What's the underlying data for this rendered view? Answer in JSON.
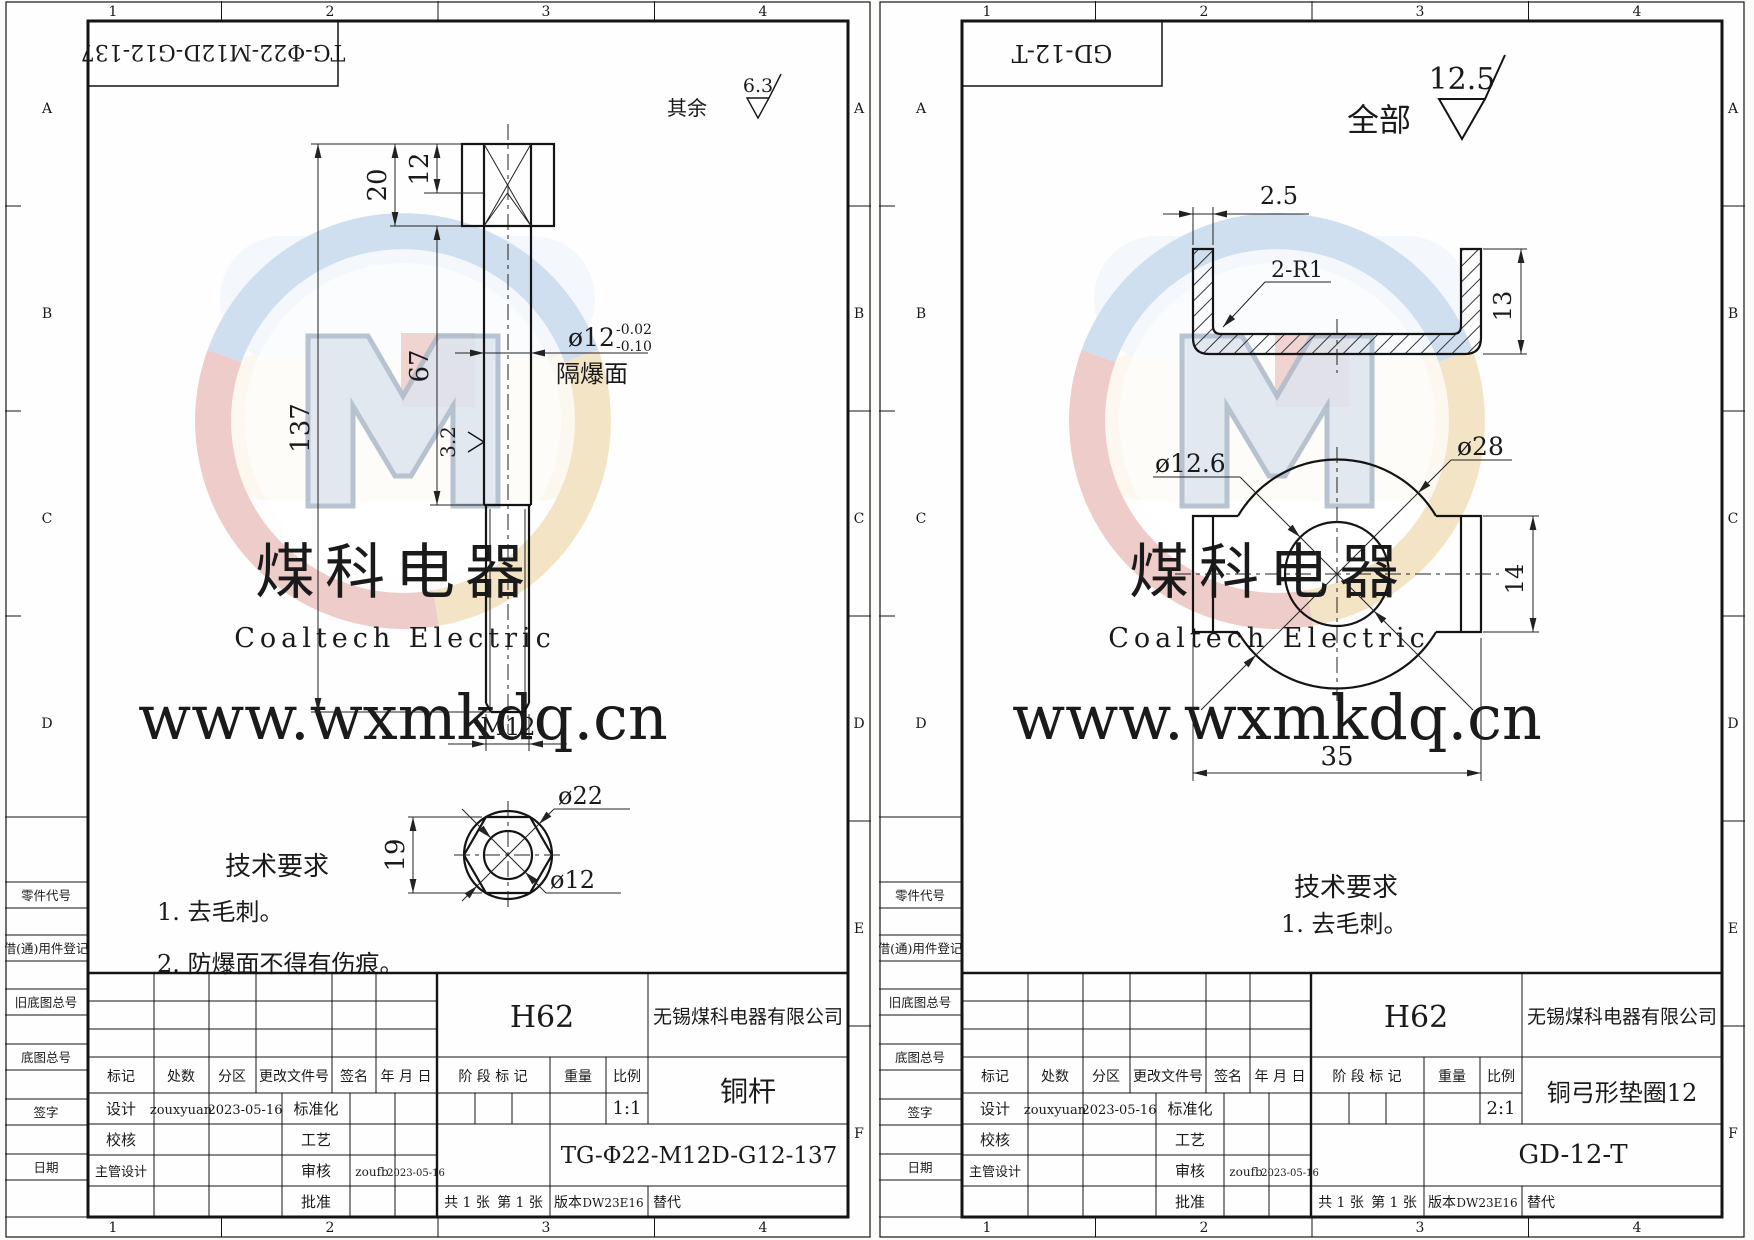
{
  "watermark": {
    "url": "www.wxmkdq.cn",
    "brand_cn": "煤科电器",
    "brand_en": "Coaltech Electric"
  },
  "zones": {
    "cols": [
      "1",
      "2",
      "3",
      "4"
    ],
    "rows": [
      "A",
      "B",
      "C",
      "D",
      "E",
      "F"
    ]
  },
  "margin_labels": [
    "零件代号",
    "借(通)用件登记",
    "旧底图总号",
    "底图总号",
    "签字",
    "日期"
  ],
  "tb_labels": {
    "mark": "标记",
    "count": "处数",
    "zone": "分区",
    "change_doc": "更改文件号",
    "sign": "签名",
    "date": "年 月 日",
    "design": "设计",
    "standard": "标准化",
    "check": "校核",
    "process": "工艺",
    "chief_design": "主管设计",
    "audit": "审核",
    "approve": "批准",
    "stage": "阶 段 标 记",
    "weight": "重量",
    "scale": "比例",
    "sheets": "共 1 张",
    "sheet_no": "第 1 张",
    "version": "版本",
    "replace": "替代"
  },
  "sheet1": {
    "doc_no_top": "TG-Φ22-M12D-G12-137",
    "finish": {
      "prefix": "其余",
      "value": "6.3"
    },
    "dims": {
      "d20": "20",
      "d12": "12",
      "d137": "137",
      "d67": "67",
      "dia12": "ø12",
      "tol_up": "-0.02",
      "tol_dn": "-0.10",
      "flameproof": "隔爆面",
      "rough": "3.2",
      "thread": "M12",
      "d19": "19",
      "dia22": "ø22",
      "dia12b": "ø12"
    },
    "tech": {
      "title": "技术要求",
      "items": [
        "1. 去毛刺。",
        "2. 防爆面不得有伤痕。"
      ]
    },
    "tb": {
      "material": "H62",
      "company": "无锡煤科电器有限公司",
      "part": "铜杆",
      "dwg_no": "TG-Φ22-M12D-G12-137",
      "scale_val": "1:1",
      "designer": "zouxyuan",
      "design_date": "2023-05-16",
      "auditor": "zoufb",
      "audit_date": "2023-05-16",
      "version_val": "DW23E16"
    }
  },
  "sheet2": {
    "doc_no_top": "GD-12-T",
    "finish": {
      "prefix": "全部",
      "value": "12.5"
    },
    "dims": {
      "t25": "2.5",
      "r": "2-R1",
      "d13": "13",
      "hole": "ø12.6",
      "outer": "ø28",
      "d14": "14",
      "d35": "35"
    },
    "tech": {
      "title": "技术要求",
      "items": [
        "1. 去毛刺。"
      ]
    },
    "tb": {
      "material": "H62",
      "company": "无锡煤科电器有限公司",
      "part": "铜弓形垫圈12",
      "dwg_no": "GD-12-T",
      "scale_val": "2:1",
      "designer": "zouxyuan",
      "design_date": "2023-05-16",
      "auditor": "zoufb",
      "audit_date": "2023-05-16",
      "version_val": "DW23E16"
    }
  }
}
